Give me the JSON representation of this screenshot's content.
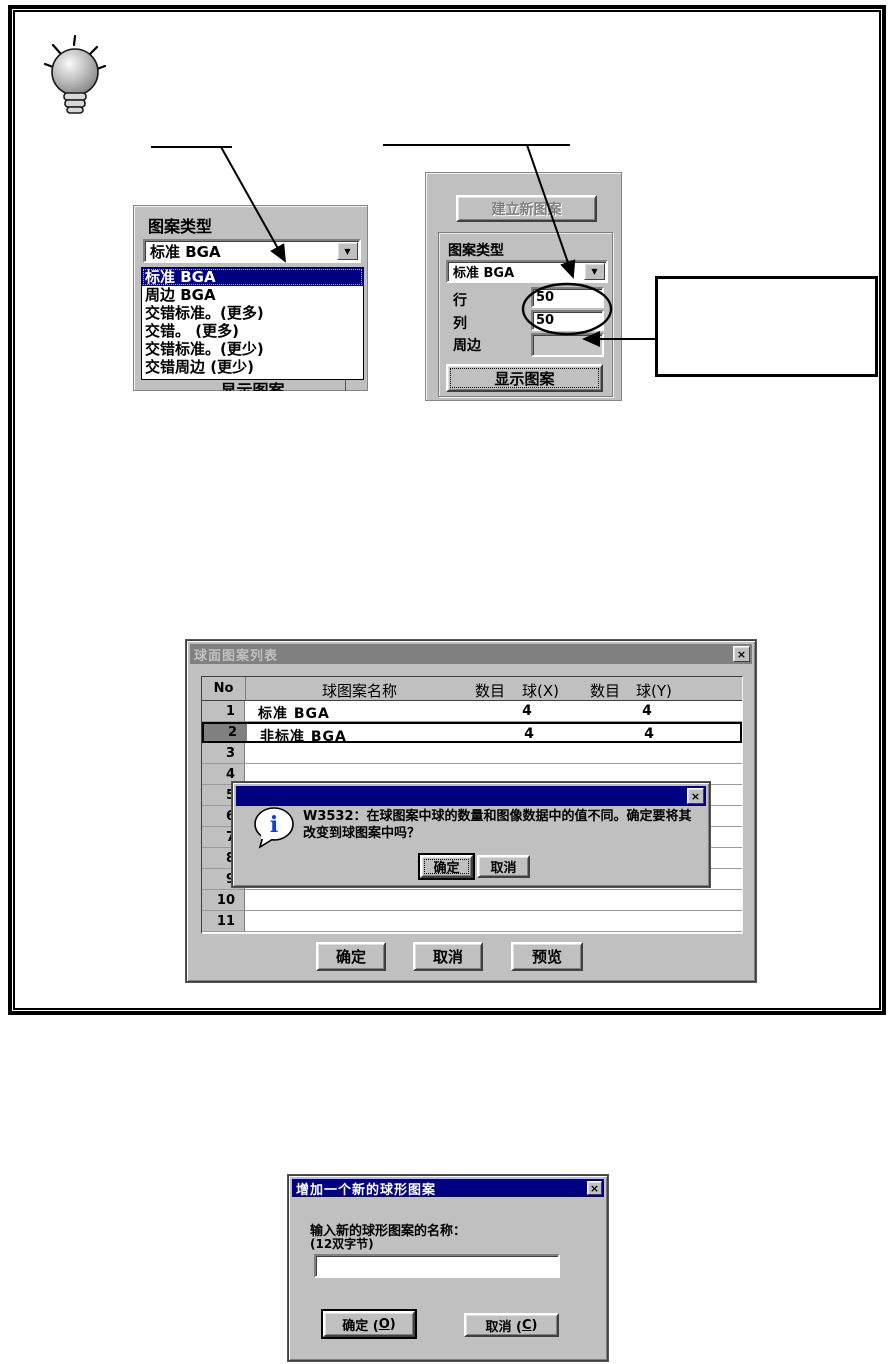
{
  "tip": {
    "icon": "lightbulb-icon"
  },
  "panel_dropdown": {
    "type_label": "图案类型",
    "combo_value": "标准 BGA",
    "dropdown_arrow": "▼",
    "items": [
      "标准 BGA",
      "周边 BGA",
      "交错标准。(更多)",
      "交错。 (更多)",
      "交错标准。(更少)",
      "交错周边 (更少)"
    ],
    "selected_item": "标准 BGA",
    "clipped_button_label": "显示图案"
  },
  "panel_settings": {
    "create_button": "建立新图案",
    "type_label": "图案类型",
    "combo_value": "标准 BGA",
    "dropdown_arrow": "▼",
    "row_label": "行",
    "row_value": "50",
    "col_label": "列",
    "col_value": "50",
    "perimeter_label": "周边",
    "perimeter_value": "",
    "show_button": "显示图案"
  },
  "callout_box": {
    "text": ""
  },
  "list_dialog": {
    "title": "球面图案列表",
    "close_glyph": "×",
    "headers": {
      "no": "No",
      "name": "球图案名称",
      "count1": "数目",
      "ball_x": "球(X)",
      "count2": "数目",
      "ball_y": "球(Y)"
    },
    "rows": [
      {
        "no": "1",
        "name": "标准 BGA",
        "ball_x": "4",
        "ball_y": "4",
        "selected": false
      },
      {
        "no": "2",
        "name": "非标准 BGA",
        "ball_x": "4",
        "ball_y": "4",
        "selected": true
      },
      {
        "no": "3",
        "name": "",
        "ball_x": "",
        "ball_y": "",
        "selected": false
      },
      {
        "no": "4",
        "name": "",
        "ball_x": "",
        "ball_y": "",
        "selected": false
      },
      {
        "no": "5",
        "name": "",
        "ball_x": "",
        "ball_y": "",
        "selected": false
      },
      {
        "no": "6",
        "name": "",
        "ball_x": "",
        "ball_y": "",
        "selected": false
      },
      {
        "no": "7",
        "name": "",
        "ball_x": "",
        "ball_y": "",
        "selected": false
      },
      {
        "no": "8",
        "name": "",
        "ball_x": "",
        "ball_y": "",
        "selected": false
      },
      {
        "no": "9",
        "name": "",
        "ball_x": "",
        "ball_y": "",
        "selected": false
      },
      {
        "no": "10",
        "name": "",
        "ball_x": "",
        "ball_y": "",
        "selected": false
      },
      {
        "no": "11",
        "name": "",
        "ball_x": "",
        "ball_y": "",
        "selected": false
      }
    ],
    "buttons": {
      "ok": "确定",
      "cancel": "取消",
      "preview": "预览"
    }
  },
  "message_dialog": {
    "title": "",
    "close_glyph": "×",
    "icon_glyph": "i",
    "text": "W3532：在球图案中球的数量和图像数据中的值不同。确定要将其改变到球图案中吗？",
    "ok": "确定",
    "cancel": "取消"
  },
  "add_dialog": {
    "title": "增加一个新的球形图案",
    "close_glyph": "×",
    "prompt": "输入新的球形图案的名称：",
    "prompt_note": "(12双字节)",
    "input_value": "",
    "ok": {
      "pre": "确定 (",
      "key": "O",
      "post": ")"
    },
    "cancel": {
      "pre": "取消 (",
      "key": "C",
      "post": ")"
    }
  }
}
